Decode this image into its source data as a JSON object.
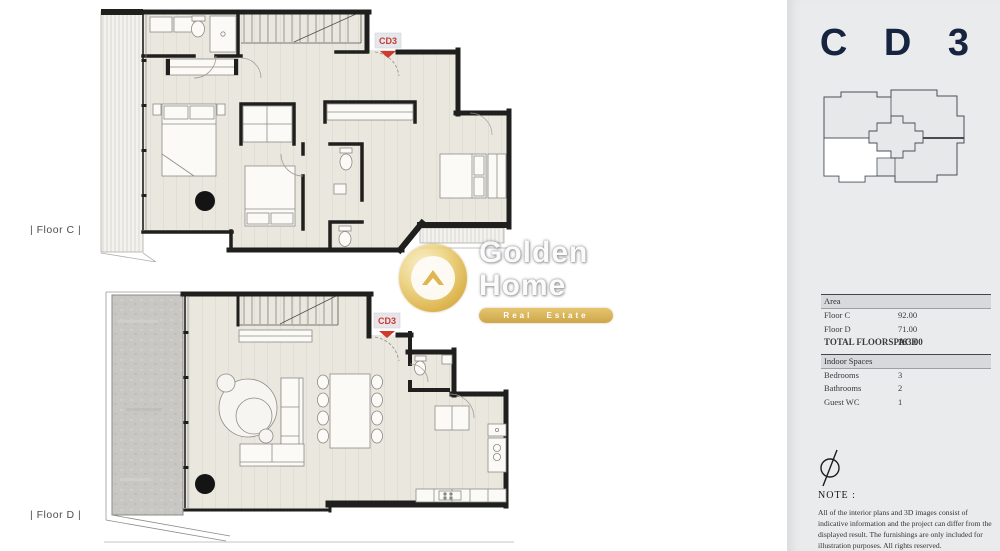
{
  "plans": {
    "floor_c": {
      "label": "| Floor C |",
      "marker": "CD3"
    },
    "floor_d": {
      "label": "| Floor D |",
      "marker": "CD3"
    }
  },
  "watermark": {
    "name_line1": "Golden",
    "name_line2": "Home",
    "banner": "Real Estate"
  },
  "sidebar": {
    "unit_title": "C D 3",
    "area_table": {
      "header": "Area",
      "rows": [
        {
          "label": "Floor C",
          "value": "92.00"
        },
        {
          "label": "Floor D",
          "value": "71.00"
        }
      ],
      "total_label": "TOTAL FLOORSPACE",
      "total_value": "163.00"
    },
    "indoor_table": {
      "header": "Indoor Spaces",
      "rows": [
        {
          "label": "Bedrooms",
          "value": "3"
        },
        {
          "label": "Bathrooms",
          "value": "2"
        },
        {
          "label": "Guest WC",
          "value": "1"
        }
      ]
    },
    "note": {
      "title": "NOTE :",
      "body": "All of the interior plans and 3D images consist of indicative information and the project can differ from the displayed result. The furnishings are only included for illustration purposes. All rights reserved."
    }
  },
  "colors": {
    "accent_navy": "#16243f",
    "marker_red": "#c63b30",
    "gold": "#d9ab35",
    "wall": "#1f1f1d",
    "floor": "#eae7df",
    "terrace": "#c8c7c4",
    "sidebar_bg": "#e9ebed"
  }
}
